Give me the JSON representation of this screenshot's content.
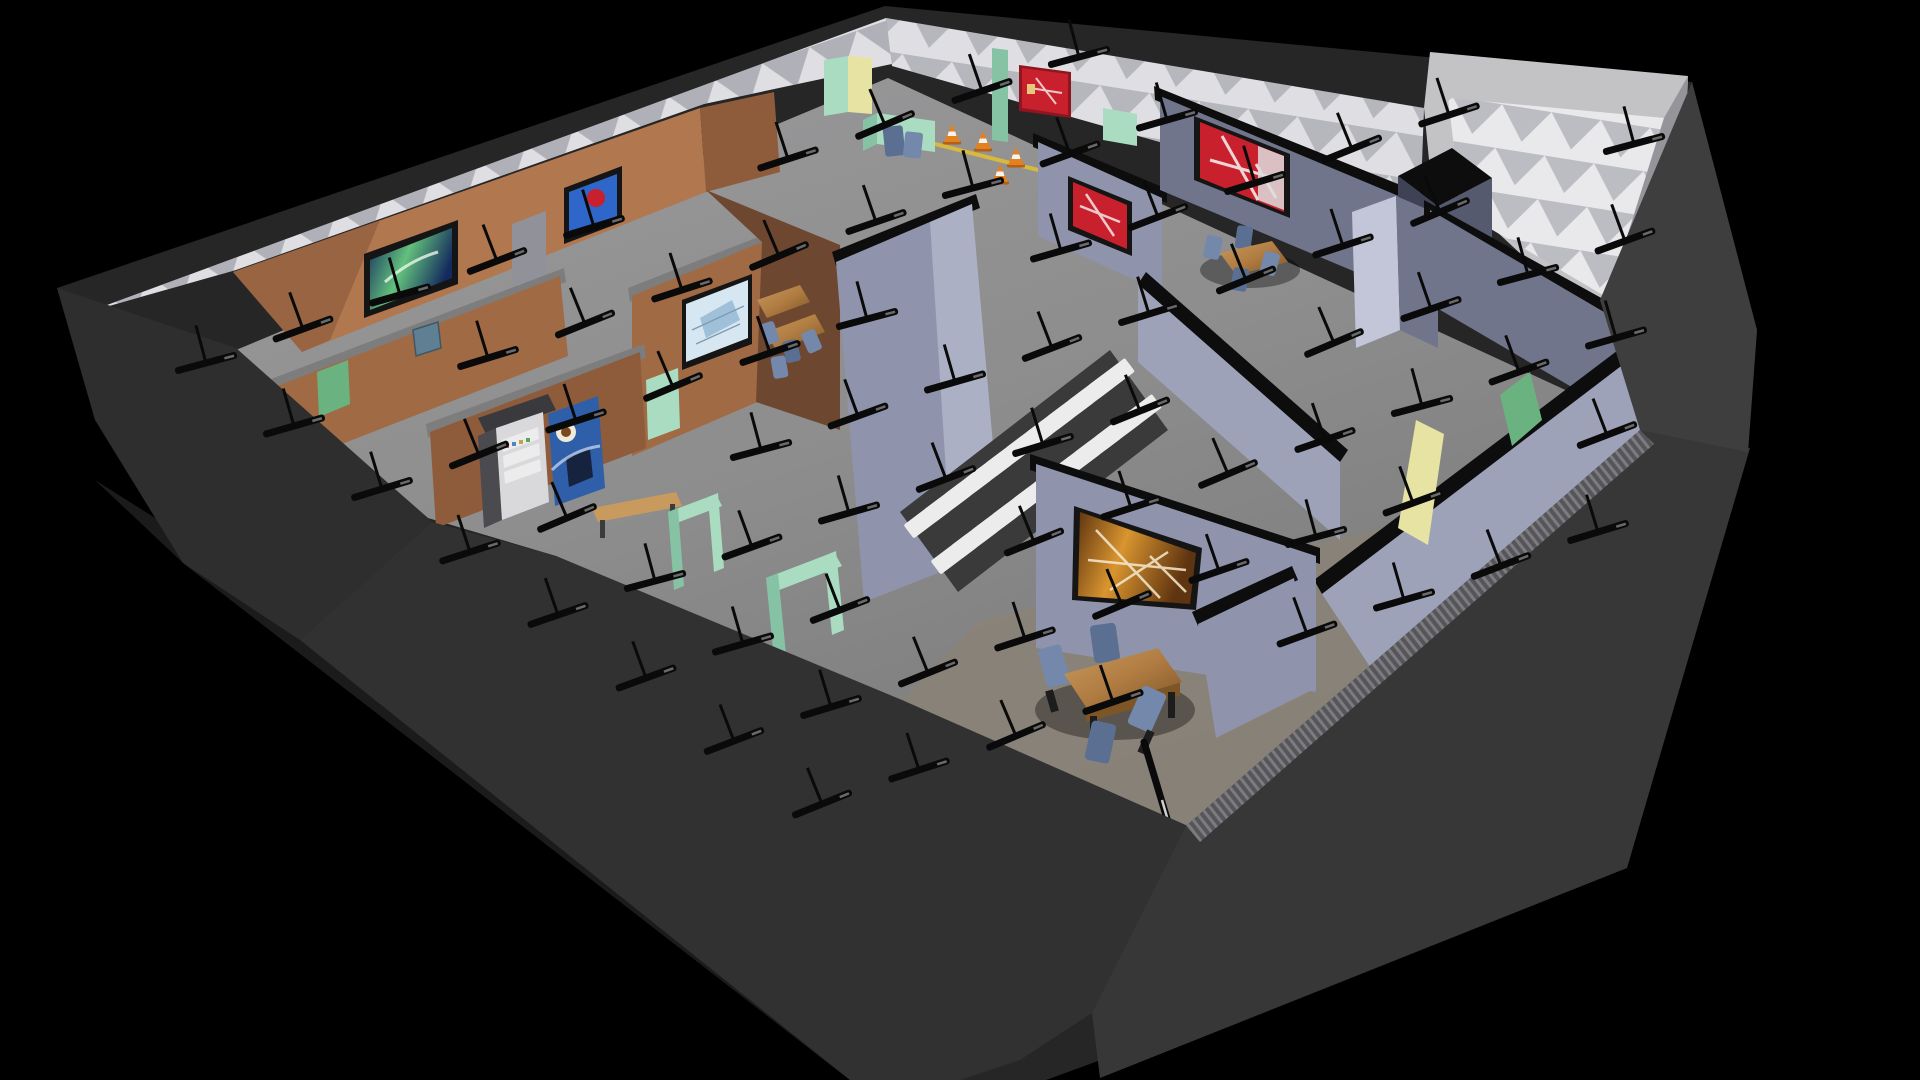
{
  "scene": {
    "title": "isometric-cutaway-office-render",
    "description": "Top-down angled cutaway 3D render of an office floor: brown-walled offices left, blue-gray offices right, white scallop-lit perimeter, central stairwell, dining sets, vending machines, traffic cones, pendant light fixtures",
    "rooms": [
      "brown-office-a",
      "brown-office-b",
      "kitchen-vending-nook",
      "white-lobby",
      "cafeteria",
      "blue-office-block",
      "stairwell",
      "utility-tower"
    ],
    "objects": {
      "paintings": 8,
      "vending_machines": 2,
      "dining_tables": 4,
      "chairs": 13,
      "traffic_cones": 4,
      "mint_door_frames": 2,
      "doors": 8,
      "stairs_flights": 2,
      "pendant_lights_approx": 55,
      "fallen_pendant_light": 1
    }
  },
  "palette": {
    "bg": "#000000",
    "extBase": "#262626",
    "extLeft": "#2e2e2e",
    "extFront": "#313131",
    "extBR": "#373737",
    "extRight": "#3e3e3e",
    "plinth": "#1b1b1b",
    "towerRim": "#c3c3c6",
    "towerWhite": "#e9e9ec",
    "towerSide": "#94949a",
    "bandWhite": "#dfdfe3",
    "scallop": "#787a84",
    "floor": "#8d8d8d",
    "floorWarm": "#8b8277",
    "floorTop": "#9a9a9c",
    "brownLit": "#b1774f",
    "brownMid": "#a06a45",
    "brownDark": "#8f5c3b",
    "brownDeep": "#6e4730",
    "brownCap": "#7d7d7d",
    "blueLit": "#c2c6d8",
    "blueMid": "#9da2b9",
    "blueBase": "#8f94ac",
    "blueDark": "#70758c",
    "blueDeep": "#565a6e",
    "capBlack": "#0d0d0d",
    "mint": "#a9dcc0",
    "mintDark": "#86c2a4",
    "greenDoor": "#6ab380",
    "yellowDoor": "#e7e3a3",
    "doorwayGray": "#919199",
    "wood": "#b07c42",
    "woodLit": "#c89a5e",
    "woodDark": "#7d5527",
    "chair": "#7388aa",
    "chairDark": "#5b6f92",
    "stairTread": "#ececec",
    "stairBase": "#3a3a3a",
    "cone": "#e5801f",
    "coneBand": "#f4f4f4",
    "coneBase": "#b35f16",
    "lineYellow": "#d8b93e",
    "light": "#0a0a0a",
    "lightGlint": "#6a6a6a",
    "vendSnack": "#d9d9dc",
    "vendCoffee": "#2f5fa8",
    "vendSide": "#4a4a4f",
    "vendShelf": "#ececec",
    "crate": "#5f7f92",
    "red": "#c8202c",
    "redLight": "#f1dede",
    "sepiaA": "#5f3410",
    "sepiaB": "#d9952f",
    "galaxyA": "#14295d",
    "galaxyB": "#63c17d",
    "sky": "#2e66c9",
    "snowA": "#d7e7f1",
    "snowB": "#9fc0d8"
  },
  "paintings": [
    {
      "id": "galaxy-painting",
      "wall": "brown-office-a",
      "colors": [
        "#14295d",
        "#63c17d",
        "#ffffff"
      ]
    },
    {
      "id": "blue-red-abstract",
      "wall": "brown-office-a",
      "colors": [
        "#2e66c9",
        "#c8202c"
      ]
    },
    {
      "id": "winter-house-sketch",
      "wall": "brown-office-b",
      "colors": [
        "#d7e7f1",
        "#9fc0d8"
      ]
    },
    {
      "id": "red-poster-lobby",
      "wall": "white-lobby",
      "colors": [
        "#c8202c",
        "#f1dede"
      ]
    },
    {
      "id": "red-abstract-small",
      "wall": "blue-office-block",
      "colors": [
        "#c8202c",
        "#ffffff"
      ]
    },
    {
      "id": "red-abstract-large",
      "wall": "blue-office-block",
      "colors": [
        "#c8202c",
        "#ffffff"
      ]
    },
    {
      "id": "red-abstract-corridor",
      "wall": "blue-office-block",
      "colors": [
        "#c8202c",
        "#ffffff"
      ]
    },
    {
      "id": "amber-abstract",
      "wall": "blue-office-block",
      "colors": [
        "#5f3410",
        "#d9952f",
        "#ffffff"
      ]
    }
  ],
  "lights": {
    "origin": [
      118,
      300
    ],
    "u": [
      97,
      -34
    ],
    "v": [
      88,
      63
    ],
    "rows": 13,
    "cols": 9,
    "barLength": 64,
    "barThickness": 7,
    "stemHeight": 36,
    "baseAngle": -19,
    "clip": [
      [
        235,
        298
      ],
      [
        888,
        34
      ],
      [
        1688,
        120
      ],
      [
        1700,
        300
      ],
      [
        1560,
        770
      ],
      [
        1100,
        990
      ],
      [
        560,
        720
      ],
      [
        200,
        500
      ],
      [
        110,
        330
      ]
    ]
  },
  "stairs": {
    "flights": 2,
    "steps": 10,
    "start": [
      927,
      518
    ],
    "step": [
      20.5,
      -15.5
    ],
    "flightOffset": [
      27,
      36
    ],
    "treadW": 46,
    "treadH": 17,
    "angle": -37,
    "base": [
      [
        900,
        512
      ],
      [
        1110,
        350
      ],
      [
        1168,
        430
      ],
      [
        958,
        592
      ]
    ]
  },
  "cones": {
    "positions": [
      [
        952,
        134
      ],
      [
        983,
        141
      ],
      [
        1016,
        157
      ],
      [
        1000,
        174
      ]
    ]
  }
}
